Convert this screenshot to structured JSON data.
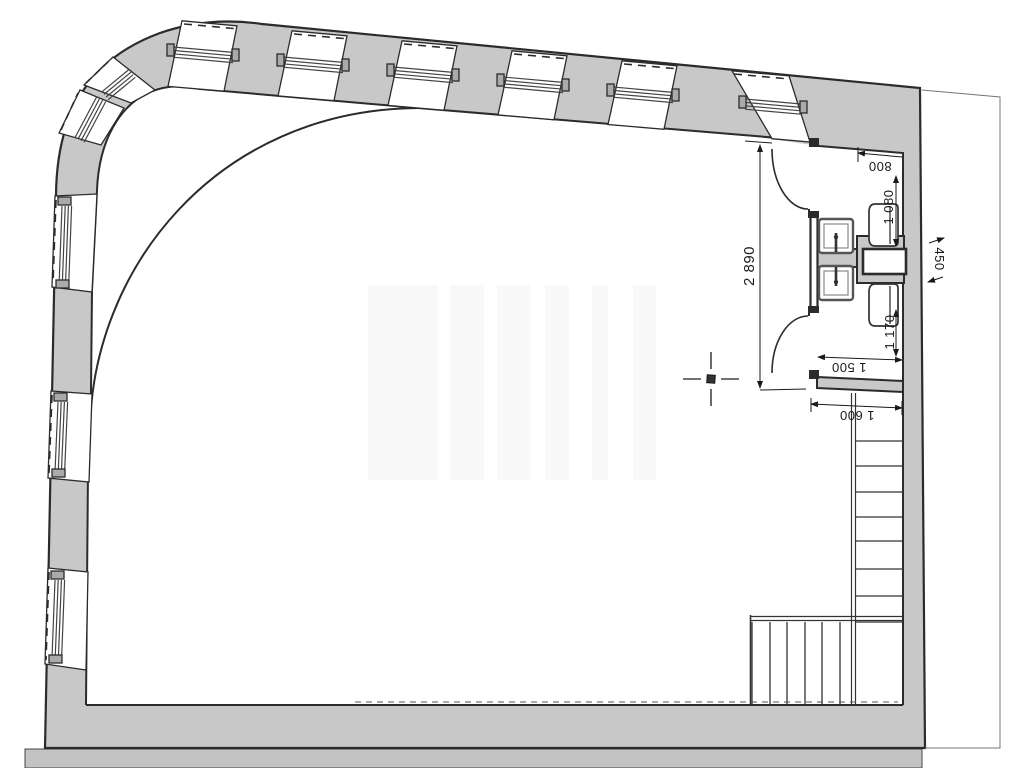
{
  "drawing": {
    "type": "architectural-floor-plan",
    "dimensions": {
      "wc_overall_height": "2 890",
      "wc_cell_top_width": "800",
      "wc_cell_top_depth": "1 080",
      "side_strip_offset": "450",
      "wc_cell_bottom_depth": "1 170",
      "wc_cell_bottom_width": "1 500",
      "stair_opening_width": "1 600"
    },
    "colors": {
      "wall_fill": "#c8c8c8",
      "ground_fill": "#c3c3c3",
      "line": "#2b2b2b",
      "dimension_text": "#1a1a1a",
      "background": "#ffffff"
    }
  }
}
